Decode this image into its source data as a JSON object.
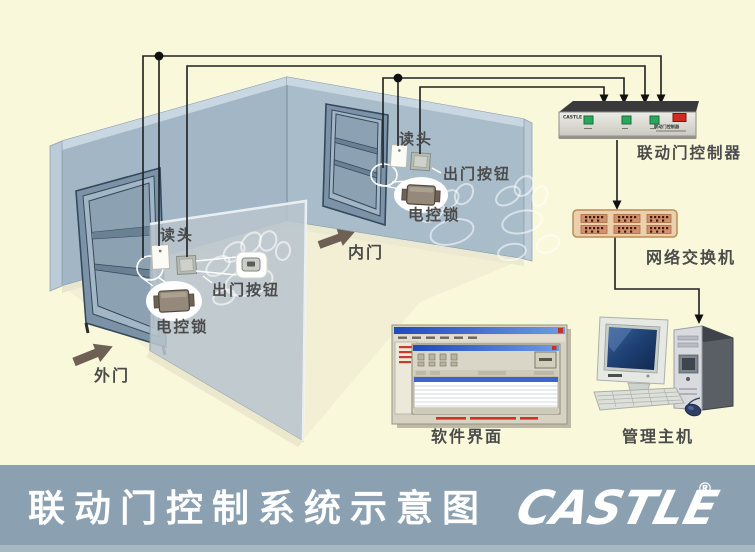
{
  "diagram": {
    "outer_door": {
      "label": "外门",
      "reader": "读头",
      "exit_button": "出门按钮",
      "lock": "电控锁"
    },
    "inner_door": {
      "label": "内门",
      "reader": "读头",
      "exit_button": "出门按钮",
      "lock": "电控锁"
    },
    "controller": {
      "label": "联动门控制器",
      "brand": "CASTLE",
      "panel_text": "联动门控制器"
    },
    "network_switch": {
      "label": "网络交换机"
    },
    "software": {
      "label": "软件界面"
    },
    "host": {
      "label": "管理主机"
    }
  },
  "banner": {
    "title": "联动门控制系统示意图",
    "logo": "CASTLE",
    "registered": "®"
  },
  "colors": {
    "background": "#FAF8DB",
    "banner": "#8BA0B0",
    "banner_strip": "#A7B8C3",
    "wall": "#A2B6C6",
    "wall_right": "#A8BCCA",
    "wall_edge": "#C8D7E1",
    "glass": "#B8C5CE",
    "door": "#7C92A6",
    "wire": "#1F1F1F",
    "button_green": "#2CA65C",
    "switch_red": "#D02A22",
    "port_tan": "#D2906C",
    "label_gray": "#4B4B4B"
  }
}
